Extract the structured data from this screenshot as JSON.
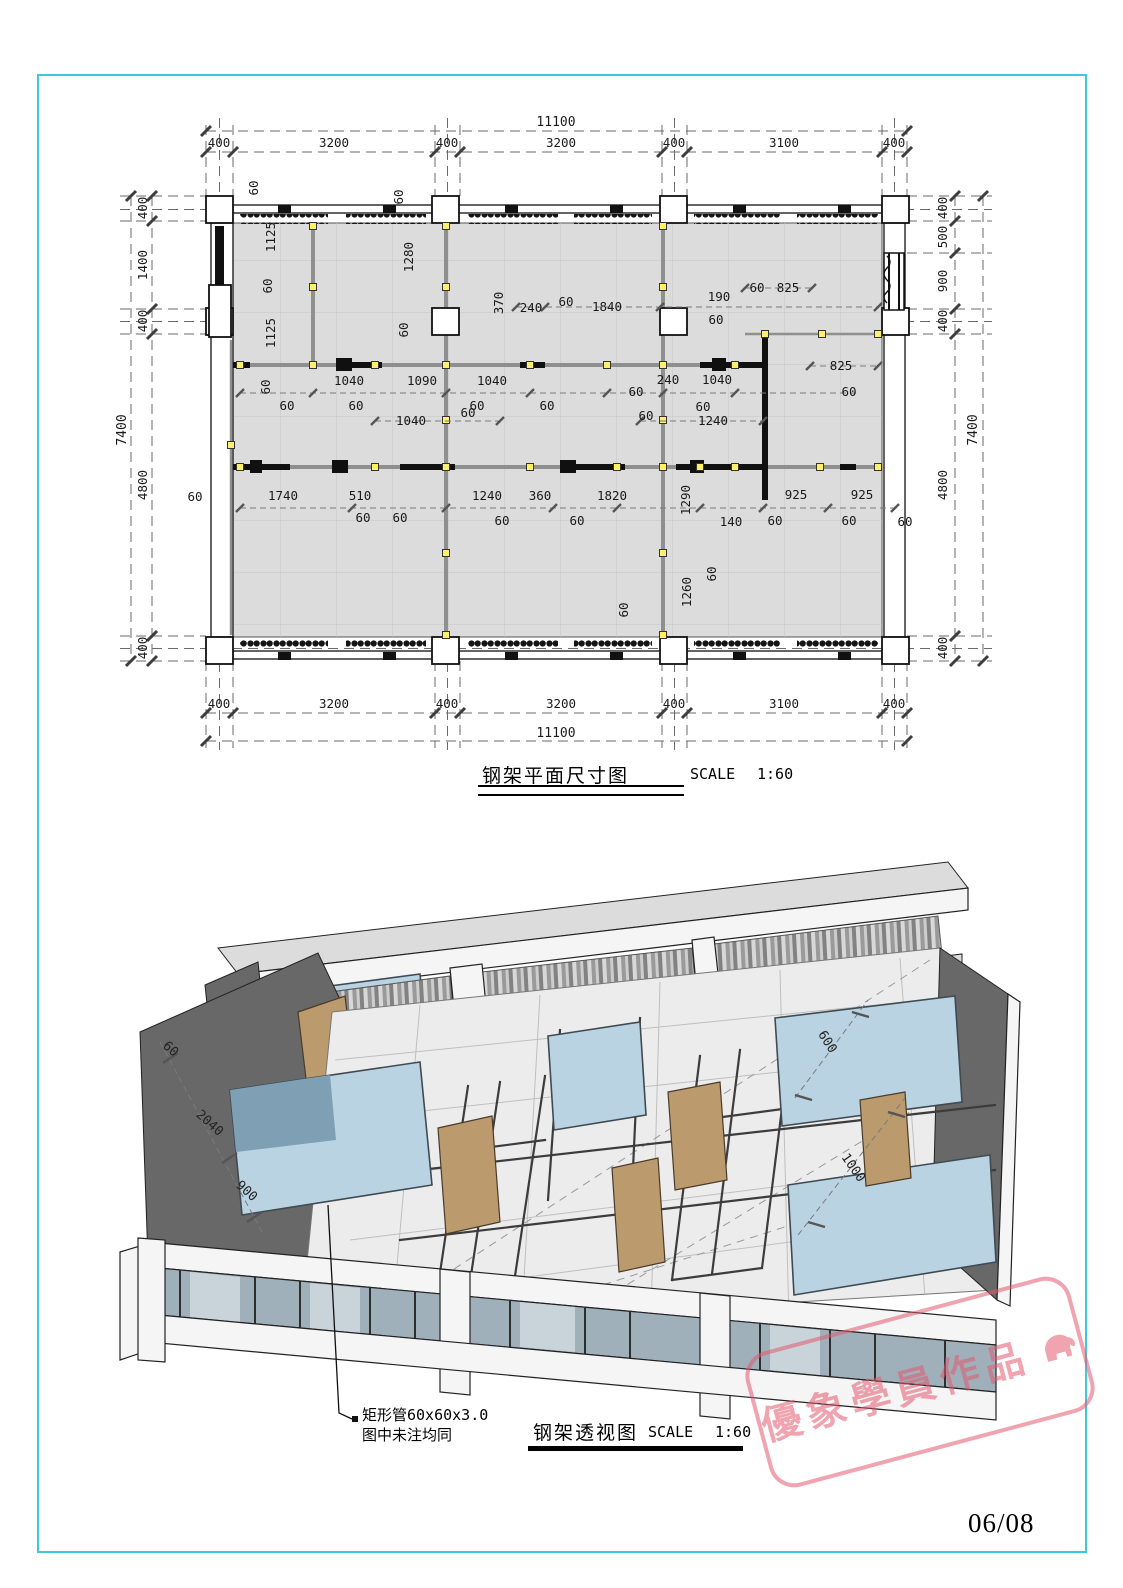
{
  "page": {
    "number": "06/08"
  },
  "palette": {
    "frame_border": "#3fc8dd",
    "floor_fill": "#dcdcdc",
    "wall_dark": "#686868",
    "glass_blue": "#b9d3e2",
    "door_tan": "#bb9a6e",
    "node_yellow": "#ffef6a",
    "watermark_red": "#e25a6e"
  },
  "plan": {
    "title": "钢架平面尺寸图",
    "scale_label": "SCALE",
    "scale_value": "1:60",
    "dim_top_total": "11100",
    "dim_top": [
      "400",
      "3200",
      "400",
      "3200",
      "400",
      "3100",
      "400"
    ],
    "dim_bottom": [
      "400",
      "3200",
      "400",
      "3200",
      "400",
      "3100",
      "400"
    ],
    "dim_bottom_total": "11100",
    "dim_left_total": "7400",
    "dim_left": [
      "400",
      "1400",
      "400",
      "4800",
      "400"
    ],
    "dim_right": [
      "400",
      "500",
      "900",
      "400",
      "4800",
      "400"
    ],
    "dim_right_total": "7400",
    "inner_dims": [
      "60",
      "60",
      "1125",
      "60",
      "1125",
      "1280",
      "60",
      "370",
      "240",
      "60",
      "1840",
      "190",
      "60",
      "825",
      "60",
      "825",
      "60",
      "60",
      "1040",
      "1090",
      "1040",
      "240",
      "1040",
      "60",
      "60",
      "60",
      "60",
      "60",
      "60",
      "1040",
      "60",
      "60",
      "1240",
      "60",
      "1740",
      "510",
      "1240",
      "360",
      "1820",
      "1290",
      "140",
      "925",
      "925",
      "60",
      "60",
      "60",
      "60",
      "60",
      "60",
      "60",
      "60",
      "1260",
      "60"
    ]
  },
  "perspective": {
    "title": "钢架透视图",
    "scale_label": "SCALE",
    "scale_value": "1:60",
    "annotation_line1": "矩形管60x60x3.0",
    "annotation_line2": "图中未注均同",
    "dims": [
      "60",
      "2040",
      "900",
      "600",
      "1000"
    ]
  },
  "watermark": {
    "text": "優象學員作品",
    "icon": "elephant-icon"
  }
}
